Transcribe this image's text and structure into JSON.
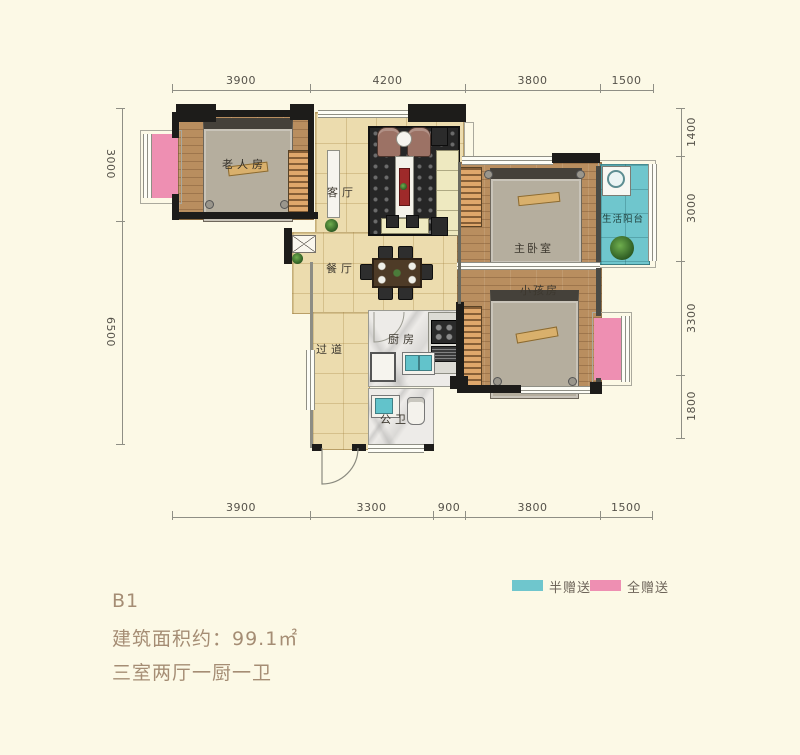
{
  "info": {
    "unit": "B1",
    "area": "建筑面积约：99.1㎡",
    "layout": "三室两厅一厨一卫"
  },
  "legend": {
    "half": {
      "label": "半赠送",
      "color": "#6fc6cd"
    },
    "full": {
      "label": "全赠送",
      "color": "#ee8fb2"
    }
  },
  "dims": {
    "top": [
      "3900",
      "4200",
      "3800",
      "1500"
    ],
    "bottom": [
      "3900",
      "3300",
      "900",
      "3800",
      "1500"
    ],
    "left": [
      "3000",
      "6500"
    ],
    "right": [
      "1400",
      "3000",
      "3300",
      "1800"
    ]
  },
  "rooms": {
    "elder": "老人房",
    "living": "客厅",
    "dining": "餐厅",
    "corridor": "过道",
    "kitchen": "厨房",
    "bath": "公卫",
    "master": "主卧室",
    "kids": "小孩房",
    "balcony": "生活阳台"
  },
  "colors": {
    "background": "#fcf9e6",
    "wall": "#1d1c1a",
    "half_gift": "#6fc6cd",
    "full_gift": "#ee8fb2",
    "info_text": "#a58d74"
  }
}
